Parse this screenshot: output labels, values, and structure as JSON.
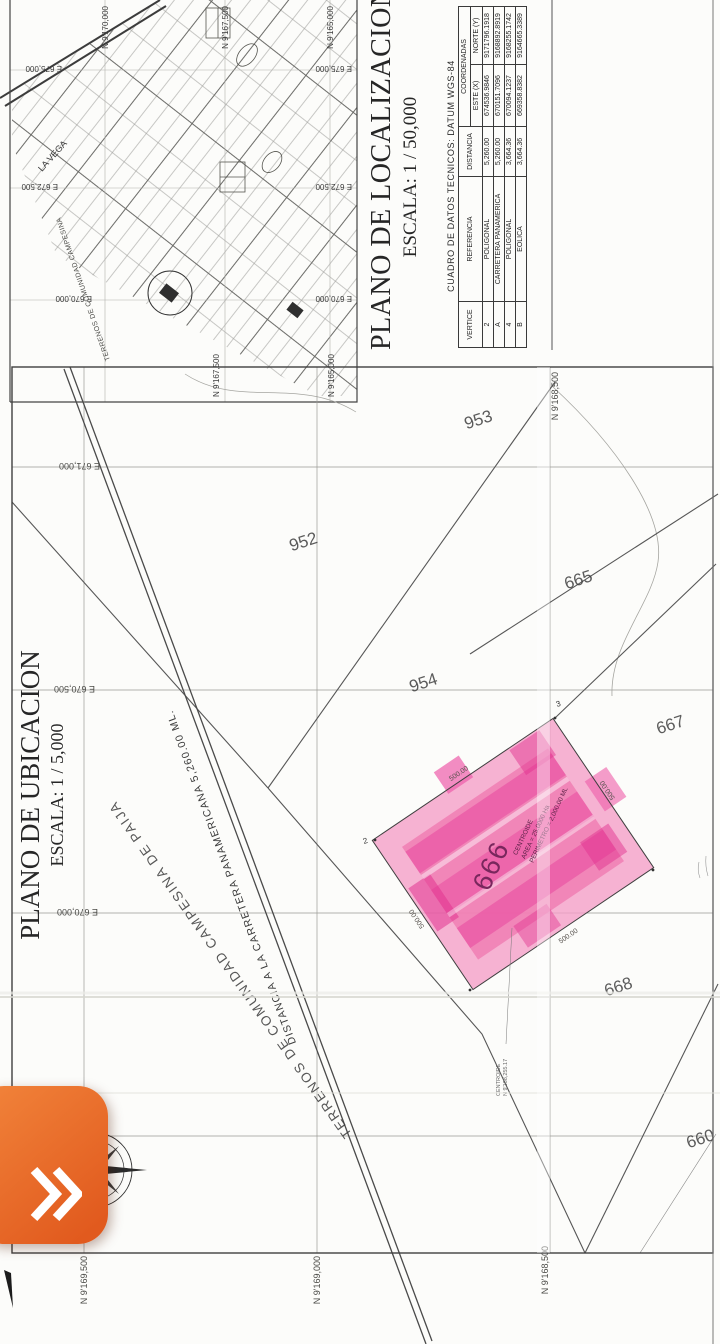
{
  "fab": {
    "icon": "chevrons-right",
    "color": "#e8601f"
  },
  "location_plan": {
    "title": "PLANO DE LOCALIZACION",
    "scale": "ESCALA: 1 / 50,000",
    "la_vega": "LA VEGA",
    "community": "TERRENOS DE COMUNIDAD CAMPESINA DE PAIJAN",
    "north_labels": [
      "N 9'170,000",
      "N 9'167,500",
      "N 9'165,000"
    ],
    "east_labels": [
      "E 675,000",
      "E 672,500",
      "E 670,000"
    ]
  },
  "tech_table": {
    "title": "CUADRO DE DATOS TECNICOS: DATUM WGS-84",
    "headers": {
      "vertice": "VERTICE",
      "referencia": "REFERENCIA",
      "distancia": "DISTANCIA",
      "coordenadas": "COORDENADAS",
      "este": "ESTE (X)",
      "norte": "NORTE (Y)"
    },
    "rows": [
      {
        "vertice": "2",
        "referencia": "POLIGONAL",
        "distancia": "5,260.00",
        "este": "674536.9846",
        "norte": "9171796.1918"
      },
      {
        "vertice": "A",
        "referencia": "CARRETERA PANAMERICA",
        "distancia": "5,260.00",
        "este": "670151.7096",
        "norte": "9168892.8919"
      },
      {
        "vertice": "4",
        "referencia": "POLIGONAL",
        "distancia": "3,664.36",
        "este": "670094.1237",
        "norte": "9168255.1742"
      },
      {
        "vertice": "B",
        "referencia": "EOLICA",
        "distancia": "3,664.36",
        "este": "669358.8382",
        "norte": "9164665.3389"
      }
    ]
  },
  "ubication_plan": {
    "title": "PLANO DE UBICACION",
    "scale": "ESCALA: 1 / 5,000",
    "compass_north": "N",
    "road_label": "DISTANCIA A LA CARRETERA PANAMERICANA 5,260.00 ML.",
    "community": "TERRENOS DE COMUNIDAD CAMPESINA DE PAIJAN",
    "north_labels": [
      "N 9'169,500",
      "N 9'169,000",
      "N 9'168,500"
    ],
    "east_labels": [
      "E 669,500",
      "E 670,000",
      "E 670,500",
      "E 671,000"
    ],
    "parcels": [
      "952",
      "953",
      "954",
      "665",
      "667",
      "668",
      "660"
    ],
    "parcel_666": {
      "number": "666",
      "centroid": "CENTROIDE",
      "area": "AREA = 25.0000 Ha",
      "perimeter": "PERIMETRO = 2,000.00 ML",
      "side": "500.00",
      "vertex_2": "2",
      "vertex_3": "3",
      "note_line1": "CENTROIDE",
      "note_line2": "N 9'168,255.17",
      "highlight_color": "#ef5da8"
    }
  }
}
